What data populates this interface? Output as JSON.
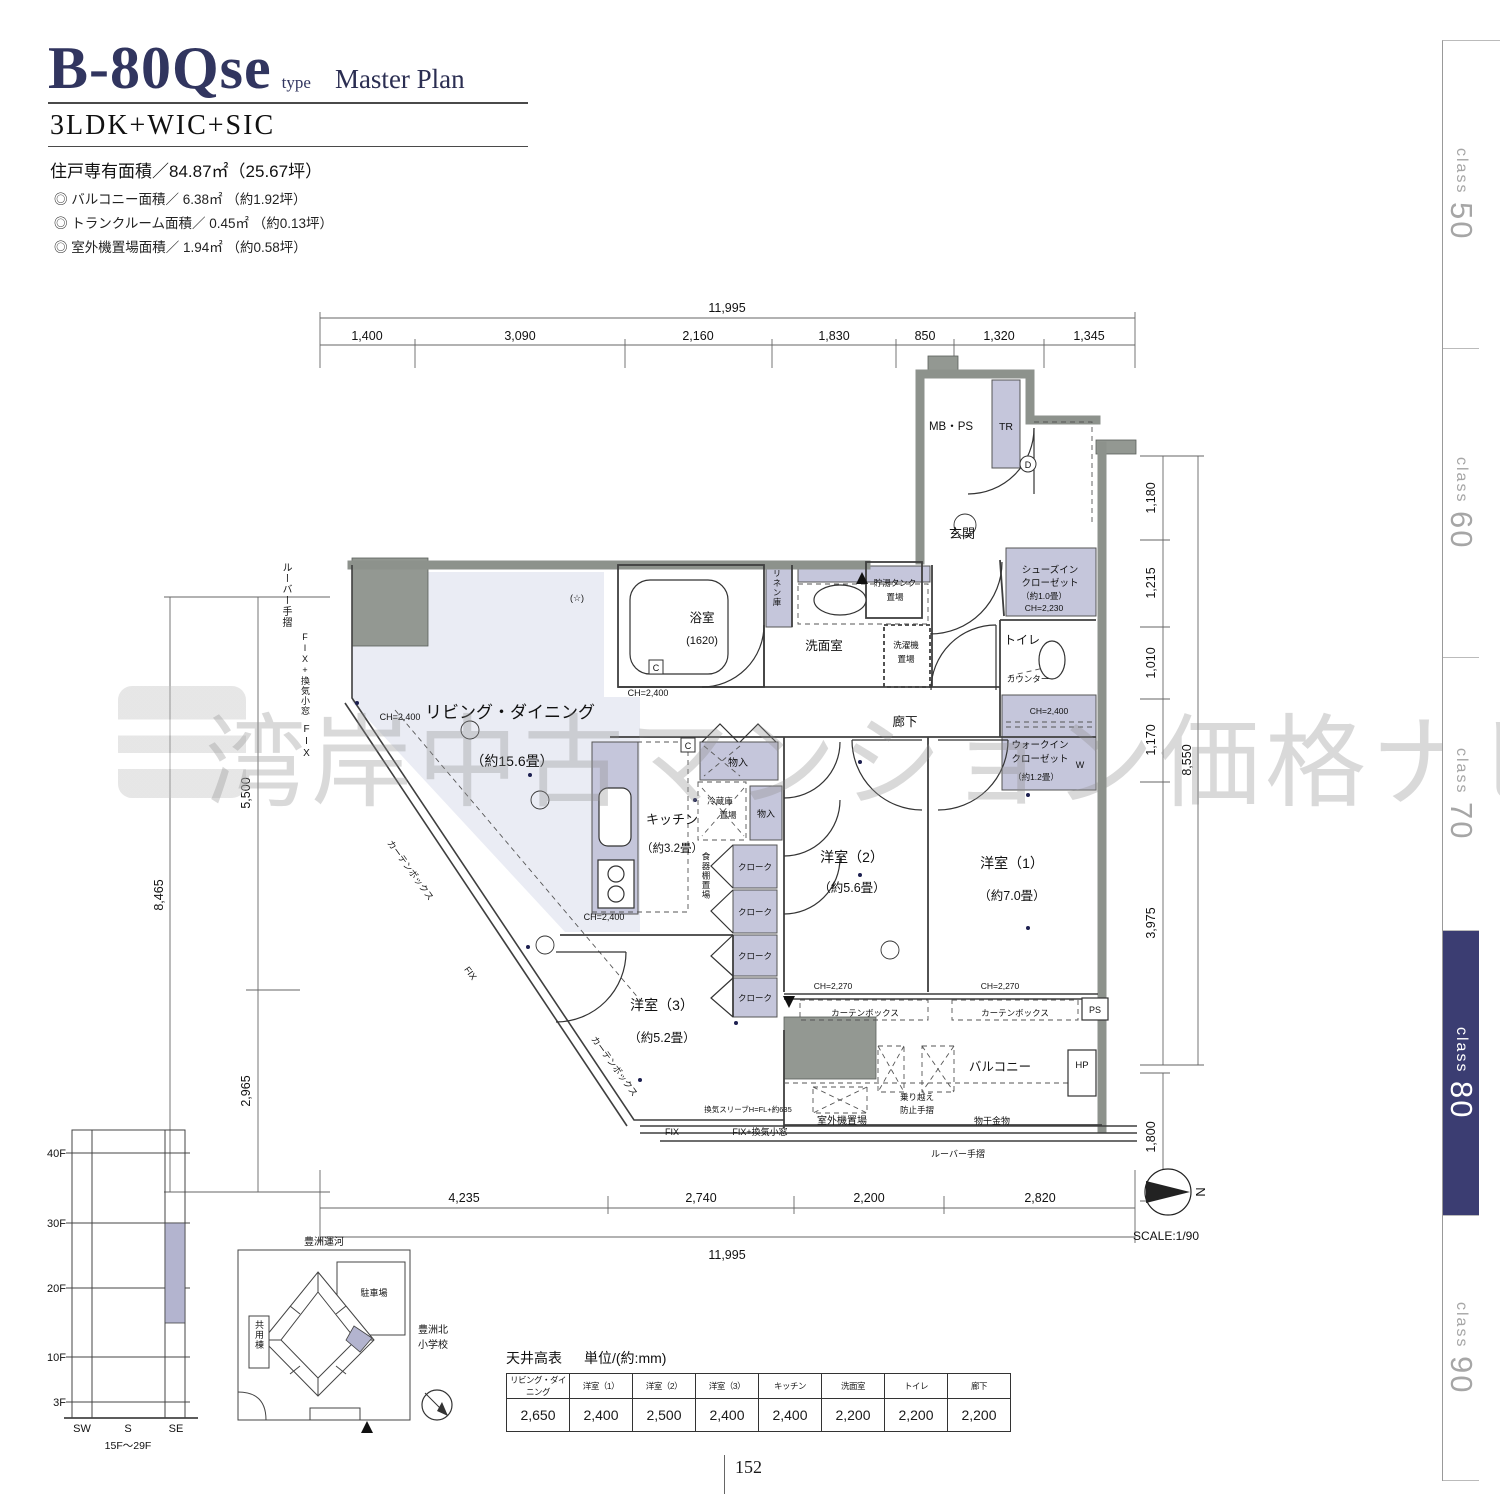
{
  "header": {
    "plan_code": "B-80Qse",
    "type_suffix": "type",
    "plan_label": "Master Plan",
    "layout": "3LDK+WIC+SIC",
    "area_main": "住戸専有面積／84.87㎡（25.67坪）",
    "area_items": [
      "◎ バルコニー面積／ 6.38㎡ （約1.92坪）",
      "◎ トランクルーム面積／ 0.45㎡ （約0.13坪）",
      "◎ 室外機置場面積／ 1.94㎡ （約0.58坪）"
    ]
  },
  "tabs": [
    {
      "c": "class",
      "n": "50"
    },
    {
      "c": "class",
      "n": "60"
    },
    {
      "c": "class",
      "n": "70"
    },
    {
      "c": "class",
      "n": "80"
    },
    {
      "c": "class",
      "n": "90"
    }
  ],
  "watermark": {
    "text": "湾岸中古マンション価格ナビ"
  },
  "rooms": {
    "living": {
      "n": "リビング・ダイニング",
      "s": "（約15.6畳）"
    },
    "kitchen": {
      "n": "キッチン",
      "s": "（約3.2畳）"
    },
    "b1": {
      "n": "洋室（1）",
      "s": "（約7.0畳）"
    },
    "b2": {
      "n": "洋室（2）",
      "s": "（約5.6畳）"
    },
    "b3": {
      "n": "洋室（3）",
      "s": "（約5.2畳）"
    },
    "bath": {
      "n": "浴室",
      "s": "(1620)"
    },
    "wash": "洗面室",
    "toilet": "トイレ",
    "hall": "廊下",
    "genkan": "玄関",
    "balcony": "バルコニー",
    "wic": {
      "l1": "ウォークイン",
      "l2": "クローゼット",
      "s": "（約1.2畳）",
      "ch": "CH=2,400"
    },
    "sic": {
      "l1": "シューズイン",
      "l2": "クローゼット",
      "s": "（約1.0畳）",
      "ch": "CH=2,230"
    }
  },
  "fp": {
    "mbps": "MB・PS",
    "tr": "TR",
    "linen": "リネン庫",
    "laundry1": "洗濯機",
    "laundry2": "置場",
    "tank1": "貯湯タンク",
    "tank2": "置場",
    "counter": "カウンター",
    "w": "W",
    "monoire": "物入",
    "fridge1": "冷蔵庫",
    "fridge2": "置場",
    "cloak": "クローク",
    "dish": "食器棚置場",
    "ps": "PS",
    "hp": "HP",
    "outdoor": "室外機置場",
    "norikoe1": "乗り越え",
    "norikoe2": "防止手摺",
    "monohoshi": "物干金物",
    "louver": "ルーバー手摺",
    "curtainbox": "カーテンボックス",
    "fix": "FIX",
    "fixkanki": "FIX+換気小窓",
    "sleeve": "換気スリーブH=FL+約635",
    "ch2400": "CH=2,400",
    "ch2270": "CH=2,270",
    "d_mark": "D",
    "c_mark": "C",
    "star": "(☆)"
  },
  "dims": {
    "top_total": "11,995",
    "top": [
      "1,400",
      "3,090",
      "2,160",
      "1,830",
      "850",
      "1,320",
      "1,345"
    ],
    "bottom": [
      "4,235",
      "2,740",
      "2,200",
      "2,820"
    ],
    "bottom_total": "11,995",
    "left": [
      "5,500",
      "2,965"
    ],
    "left_total": "8,465",
    "right": [
      "1,180",
      "1,215",
      "1,010",
      "1,170",
      "3,975"
    ],
    "right_total": "8,550",
    "balcony_depth": "1,800"
  },
  "compass": {
    "n": "N",
    "scale": "SCALE:1/90"
  },
  "elevation": {
    "floors": [
      "40F",
      "30F",
      "20F",
      "10F",
      "3F"
    ],
    "dirs": [
      "SW",
      "S",
      "SE"
    ],
    "caption": "15F〜29F"
  },
  "sitemap": {
    "canal": "豊洲運河",
    "parking": "駐車場",
    "common": "共用棟",
    "school1": "豊洲北",
    "school2": "小学校"
  },
  "ceiling": {
    "title": "天井高表",
    "unit": "単位/(約:mm)",
    "cols": [
      "リビング・ダイニング",
      "洋室（1）",
      "洋室（2）",
      "洋室（3）",
      "キッチン",
      "洗面室",
      "トイレ",
      "廊下"
    ],
    "vals": [
      "2,650",
      "2,400",
      "2,500",
      "2,400",
      "2,400",
      "2,200",
      "2,200",
      "2,200"
    ]
  },
  "page": {
    "number": "152"
  }
}
